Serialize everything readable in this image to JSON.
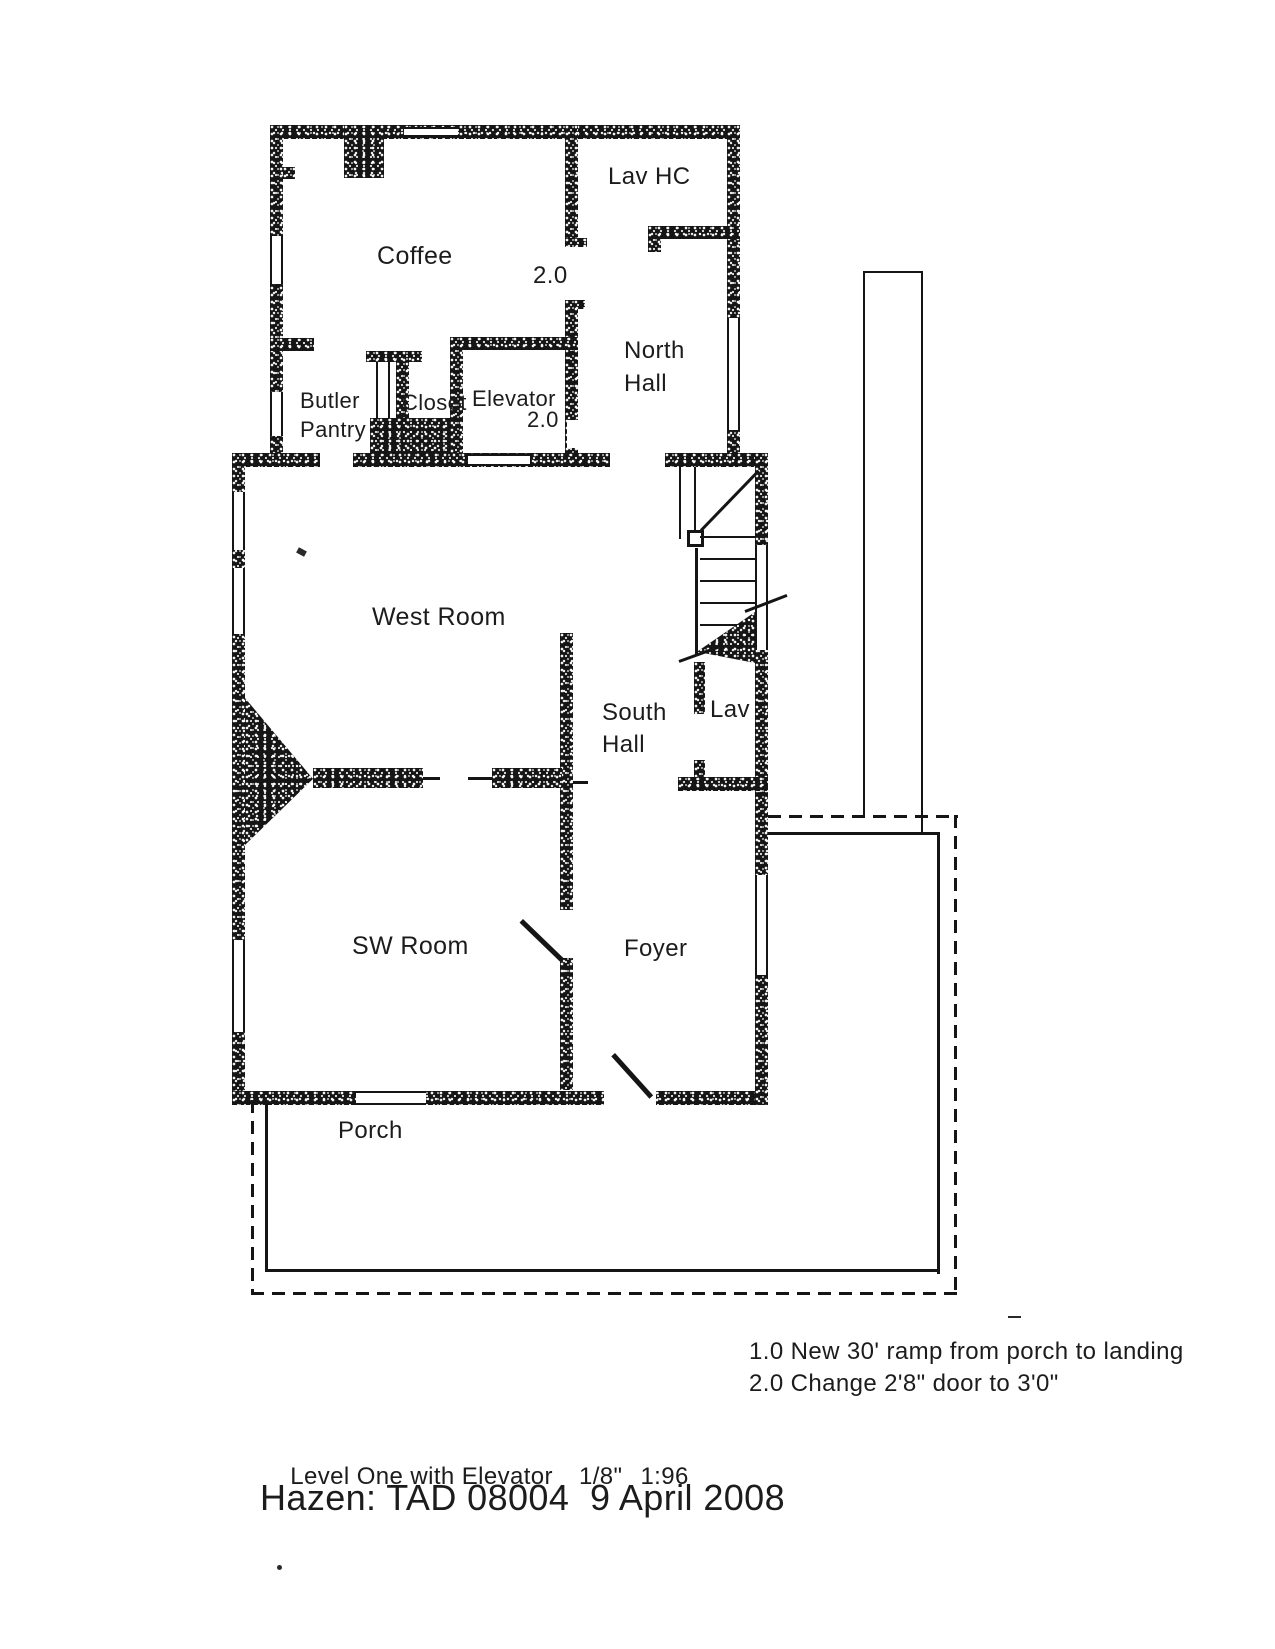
{
  "page": {
    "background": "#ffffff",
    "ink": "#151515"
  },
  "rooms": {
    "lav_hc": {
      "label": "Lav HC"
    },
    "coffee": {
      "label": "Coffee"
    },
    "north_hall": {
      "label": "North Hall"
    },
    "butler_pantry": {
      "label": "Butler Pantry"
    },
    "closet": {
      "label": "Closet"
    },
    "elevator": {
      "label": "Elevator"
    },
    "west_room": {
      "label": "West Room"
    },
    "south_hall": {
      "label": "South Hall"
    },
    "lav": {
      "label": "Lav"
    },
    "sw_room": {
      "label": "SW Room"
    },
    "foyer": {
      "label": "Foyer"
    },
    "porch": {
      "label": "Porch"
    }
  },
  "annotations": {
    "coffee_door_keynote": "2.0",
    "elevator_door_keynote": "2.0"
  },
  "notes": {
    "line1": "1.0 New 30' ramp from porch to landing",
    "line2": "2.0 Change 2'8\" door to 3'0\""
  },
  "footer": {
    "drawing_name": "Level One with Elevator",
    "scale_fraction": "1/8\"",
    "scale_ratio": "1:96",
    "title": "Hazen: TAD 08004  9 April 2008"
  }
}
